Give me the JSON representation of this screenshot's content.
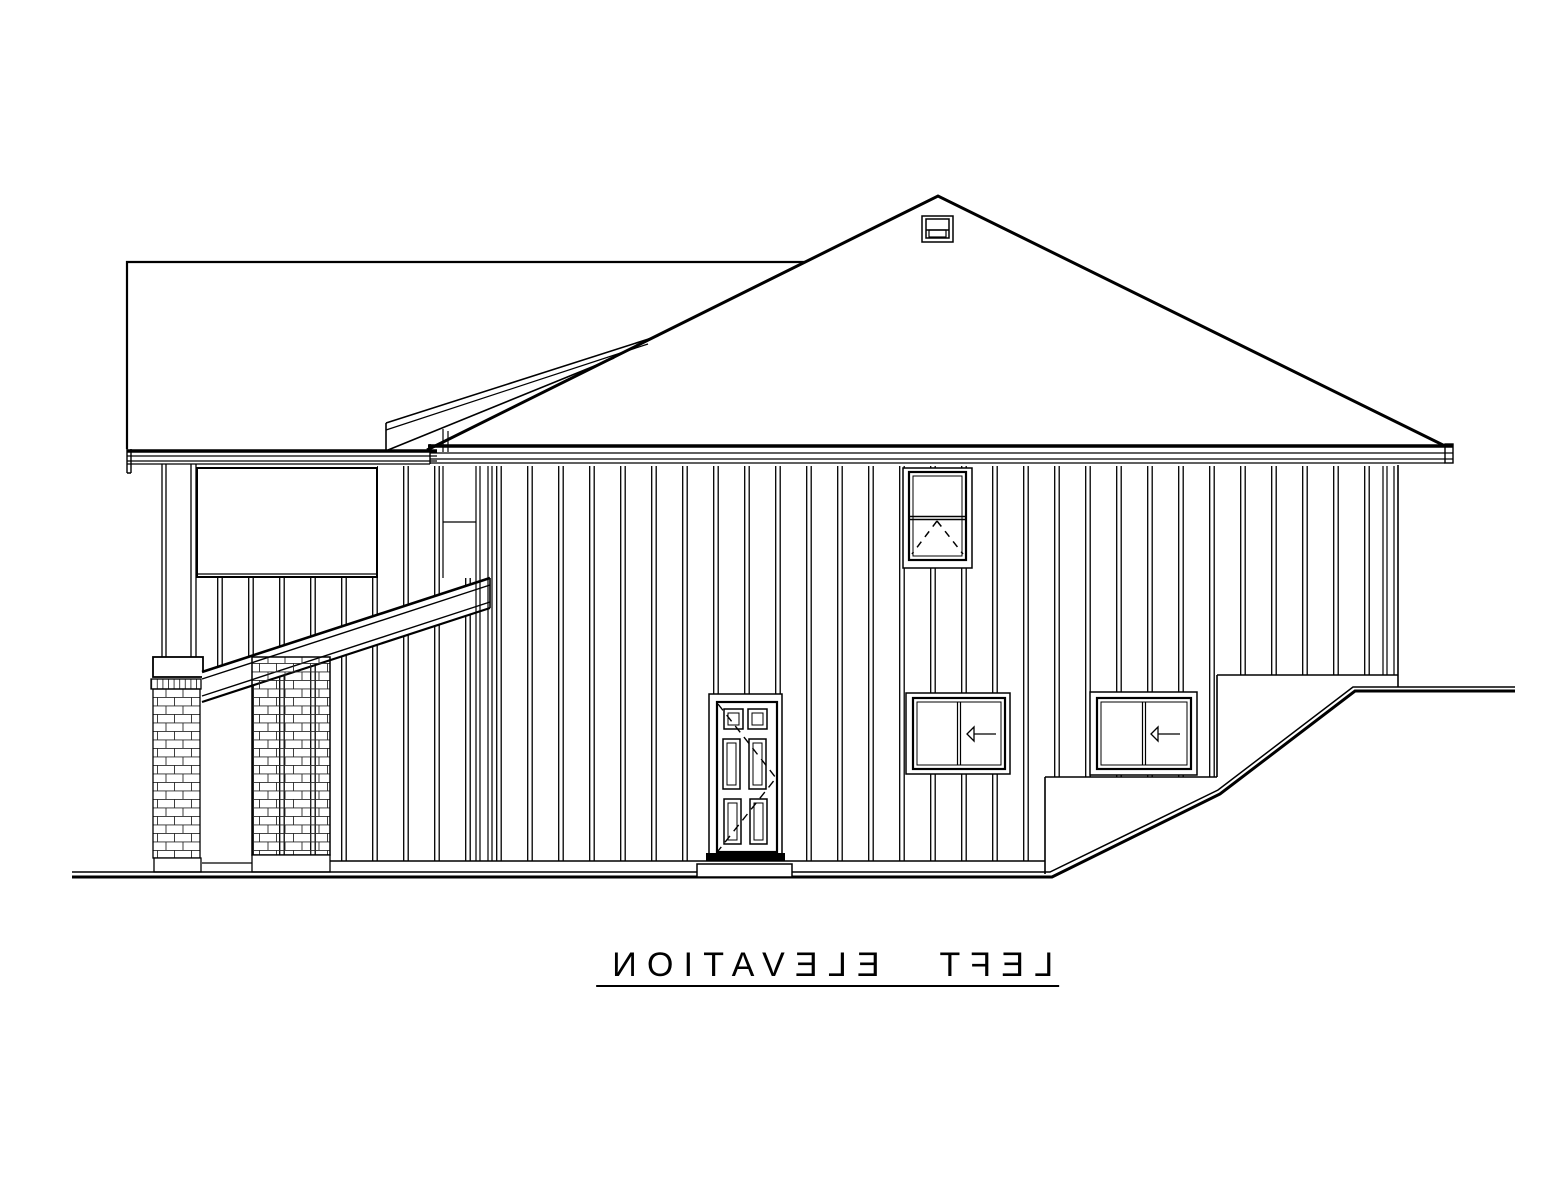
{
  "title": {
    "text": "LEFT ELEVATION",
    "mirrored": true,
    "underlined": true
  },
  "palette": {
    "background": "#ffffff",
    "line_color": "#000000",
    "brick_line_color": "#2a2a2a"
  },
  "drawing": {
    "kind": "architectural-elevation",
    "labels": {
      "roof": "hip roof",
      "ridge_vent": "ridge vent",
      "rear_wall": "rear wall block",
      "shed_fascia": "shed roof fascia",
      "porch_eave": "porch eave fascia",
      "main_eave": "main eave fascia",
      "siding": "board and batten siding",
      "porch_panel": "porch wall panel",
      "porch_post": "porch post",
      "brick_pier": "brick pier with cap",
      "brick_column": "brick column",
      "stair_rail": "sloped stair rail",
      "entry_door": "six panel entry door",
      "door_swing": "door swing dashed lines",
      "door_stoop": "door stoop",
      "awning_window": "awning window with dashed vent triangle",
      "slider_left": "sliding window with direction arrow",
      "slider_right": "sliding window with direction arrow",
      "foundation": "stepped wall base",
      "grade": "grade line rising to right"
    }
  }
}
